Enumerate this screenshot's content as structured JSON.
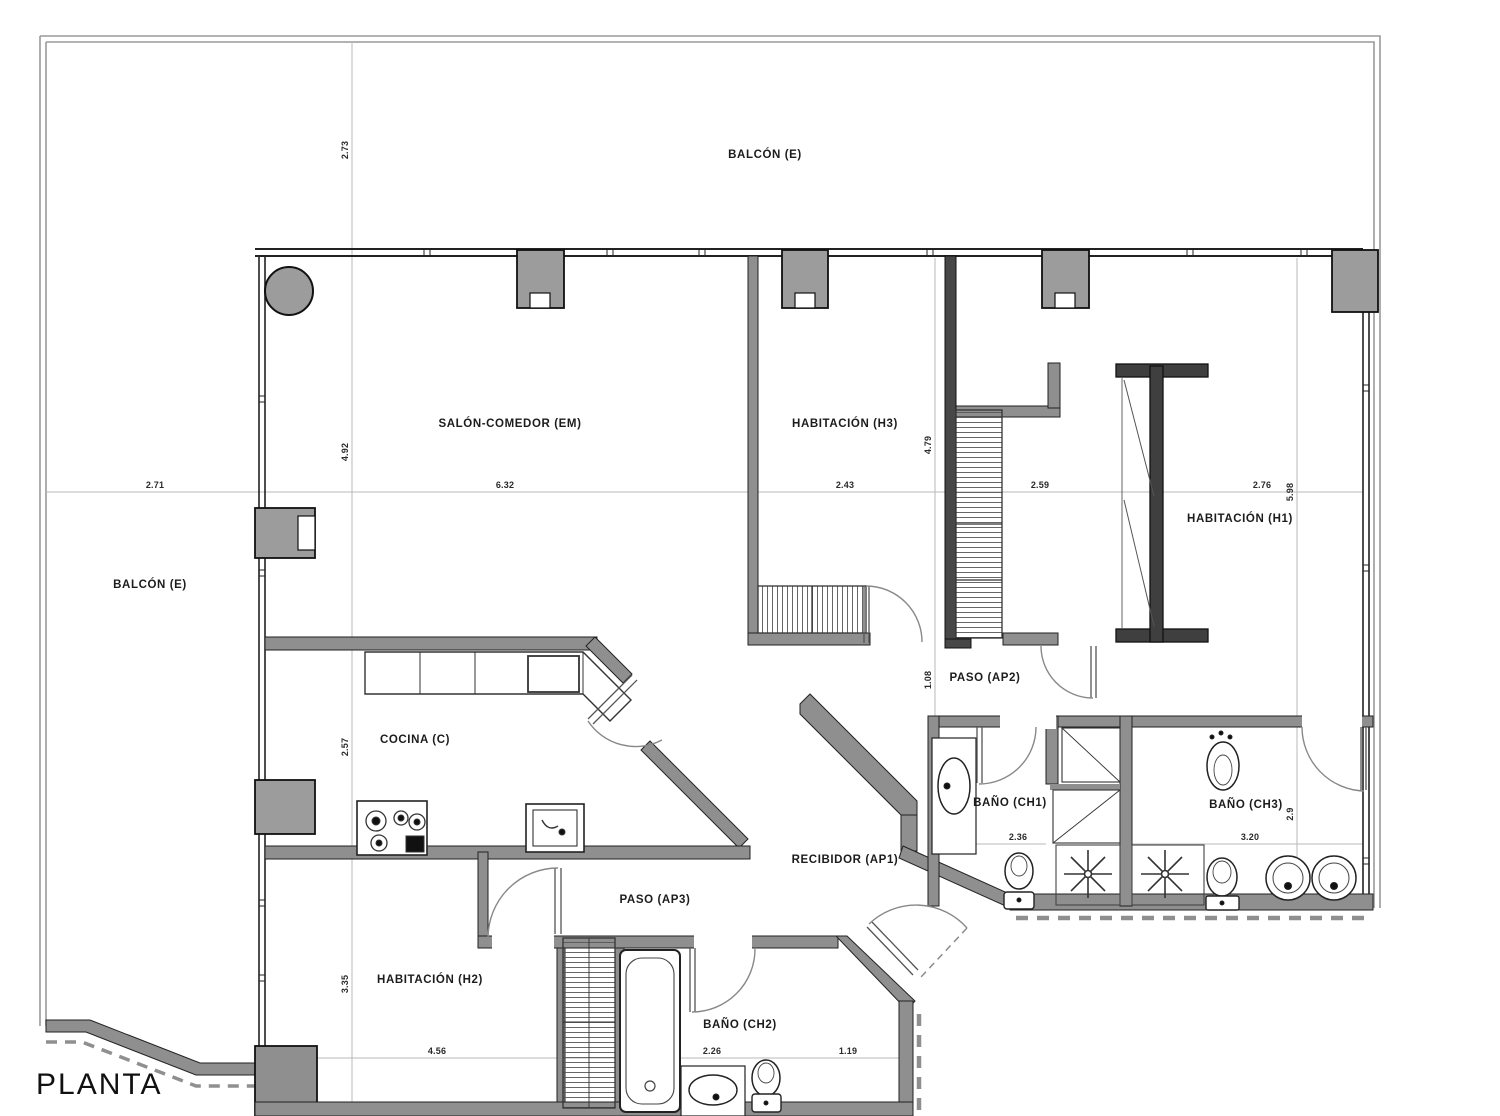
{
  "title": "PLANTA",
  "rooms": {
    "balcon_top": {
      "label": "BALCÓN (E)"
    },
    "balcon_left": {
      "label": "BALCÓN (E)"
    },
    "salon": {
      "label": "SALÓN-COMEDOR (EM)"
    },
    "h3": {
      "label": "HABITACIÓN (H3)"
    },
    "h1": {
      "label": "HABITACIÓN (H1)"
    },
    "h2": {
      "label": "HABITACIÓN (H2)"
    },
    "cocina": {
      "label": "COCINA (C)"
    },
    "paso_ap2": {
      "label": "PASO (AP2)"
    },
    "paso_ap3": {
      "label": "PASO (AP3)"
    },
    "recibidor": {
      "label": "RECIBIDOR (AP1)"
    },
    "bano_ch1": {
      "label": "BAÑO (CH1)"
    },
    "bano_ch2": {
      "label": "BAÑO (CH2)"
    },
    "bano_ch3": {
      "label": "BAÑO (CH3)"
    }
  },
  "dims": {
    "balcon_top_depth": "2.73",
    "balcon_left_width": "2.71",
    "salon_width": "6.32",
    "salon_height": "4.92",
    "h3_width": "2.43",
    "h3_height": "4.79",
    "ap2_width": "2.59",
    "ap2_passage": "1.08",
    "h1_width": "2.76",
    "h1_height": "5.98",
    "cocina_height": "2.57",
    "ch1_width": "2.36",
    "ch3_width": "3.20",
    "ch3_height": "2.9",
    "h2_height": "3.35",
    "h2_width": "4.56",
    "ch2_width": "2.26",
    "ch2_right_width": "1.19"
  },
  "colors": {
    "wall": "#8f8f8f",
    "wall_dark": "#474747",
    "pillar": "#9c9c9c",
    "line": "#222222",
    "dimline": "#b8b8b8"
  }
}
